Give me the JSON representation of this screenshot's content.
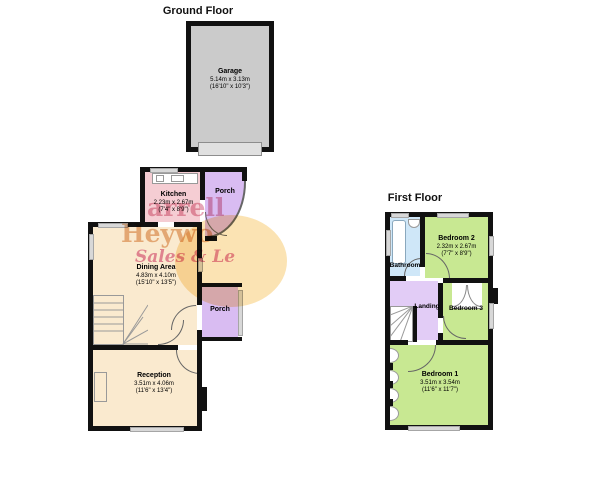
{
  "ground_floor": {
    "title": "Ground Floor",
    "garage": {
      "name": "Garage",
      "m": "5.14m x 3.13m",
      "ft": "(16'10\" x 10'3\")"
    },
    "kitchen": {
      "name": "Kitchen",
      "m": "2.23m x 2.67m",
      "ft": "(7'4\" x 8'9\")"
    },
    "porch_top": {
      "name": "Porch"
    },
    "dining": {
      "name": "Dining Area",
      "m": "4.83m x 4.10m",
      "ft": "(15'10\" x 13'5\")"
    },
    "porch_side": {
      "name": "Porch"
    },
    "reception": {
      "name": "Reception",
      "m": "3.51m x 4.06m",
      "ft": "(11'6\" x 13'4\")"
    }
  },
  "first_floor": {
    "title": "First Floor",
    "bathroom": {
      "name": "Bathroom"
    },
    "bedroom2": {
      "name": "Bedroom 2",
      "m": "2.32m x 2.67m",
      "ft": "(7'7\" x 8'9\")"
    },
    "landing": {
      "name": "Landing"
    },
    "bedroom3": {
      "name": "Bedroom 3"
    },
    "bedroom1": {
      "name": "Bedroom 1",
      "m": "3.51m x 3.54m",
      "ft": "(11'6\" x 11'7\")"
    }
  },
  "watermark": {
    "line1": "arrell",
    "line2": "Heywo",
    "line3": "Sales & Le"
  },
  "colors": {
    "wall": "#111111",
    "garage_fill": "#cbcbcb",
    "garage_door": "#e0e0e0",
    "kitchen_pink": "#f5cdd3",
    "porch_purple": "#d9bcf2",
    "cream": "#faeacf",
    "bedroom_green": "#c8e892",
    "landing_lavender": "#e2ccf6",
    "bathroom_blue": "#cfe7f8",
    "window_grey": "#d8d8d8",
    "watermark_yellow": "#f7cc74",
    "watermark_pink": "#e08fa4",
    "watermark_orange": "#e2a471",
    "watermark_magenta": "#e07ba1"
  }
}
